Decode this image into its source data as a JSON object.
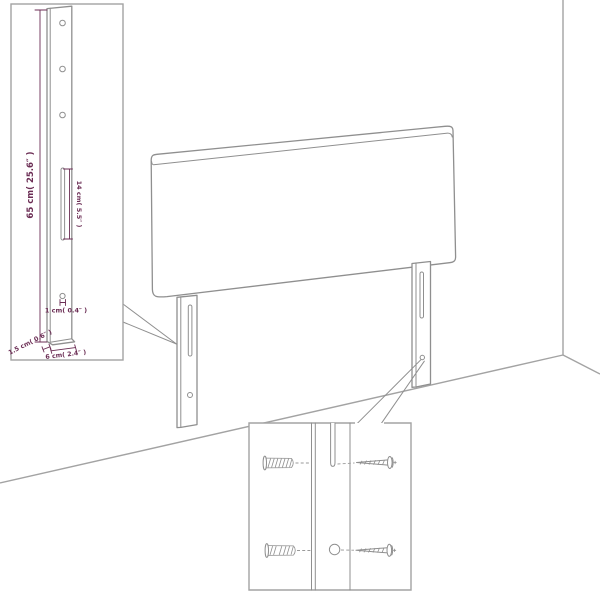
{
  "diagram": {
    "dimensions": {
      "leg_height": "65 cm( 25.6″ )",
      "slot_length": "14 cm( 5.5″ )",
      "hole_size": "1 cm( 0.4″ )",
      "leg_thickness": "1.5 cm( 0.6″ )",
      "leg_width": "6 cm( 2.4″ )"
    },
    "colors": {
      "outline_gray": "#8f8f8f",
      "room_line_gray": "#a3a3a3",
      "dimension_purple": "#6b2d54",
      "background": "#ffffff"
    }
  }
}
